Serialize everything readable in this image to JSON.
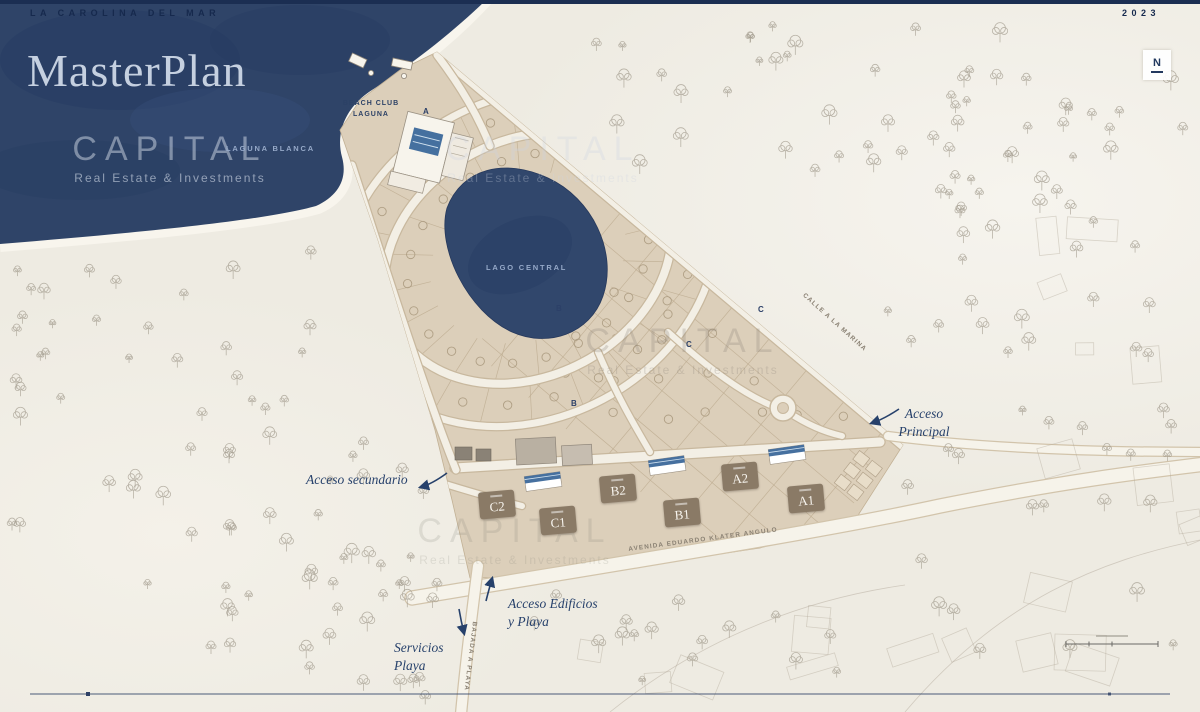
{
  "header": {
    "project": "LA CAROLINA DEL MAR",
    "title": "MasterPlan",
    "year": "2023",
    "compass_n": "N"
  },
  "watermark": {
    "brand": "CAPITAL",
    "tagline": "Real Estate & Investments"
  },
  "labels": {
    "ocean": "LAGUNA BLANCA",
    "lake": "LAGO CENTRAL",
    "beach_club_line1": "BEACH CLUB",
    "beach_club_line2": "LAGUNA",
    "street_marina": "CALLE A LA MARINA",
    "avenue": "AVENIDA EDUARDO KLATER ANGULO",
    "beach_road": "BAJADA A PLAYA",
    "acceso_secundario": "Acceso secundario",
    "acceso_principal_line1": "Acceso",
    "acceso_principal_line2": "Principal",
    "acceso_edificios_line1": "Acceso Edificios",
    "acceso_edificios_line2": "y Playa",
    "servicios_line1": "Servicios",
    "servicios_line2": "Playa"
  },
  "buildings": [
    "C2",
    "C1",
    "B2",
    "B1",
    "A2",
    "A1"
  ],
  "sectors": [
    "A",
    "B",
    "C",
    "C",
    "B"
  ],
  "colors": {
    "navy_text": "#22385f",
    "water": "#2f4468",
    "sand": "#dccfba",
    "pool_blue": "#45709f"
  }
}
